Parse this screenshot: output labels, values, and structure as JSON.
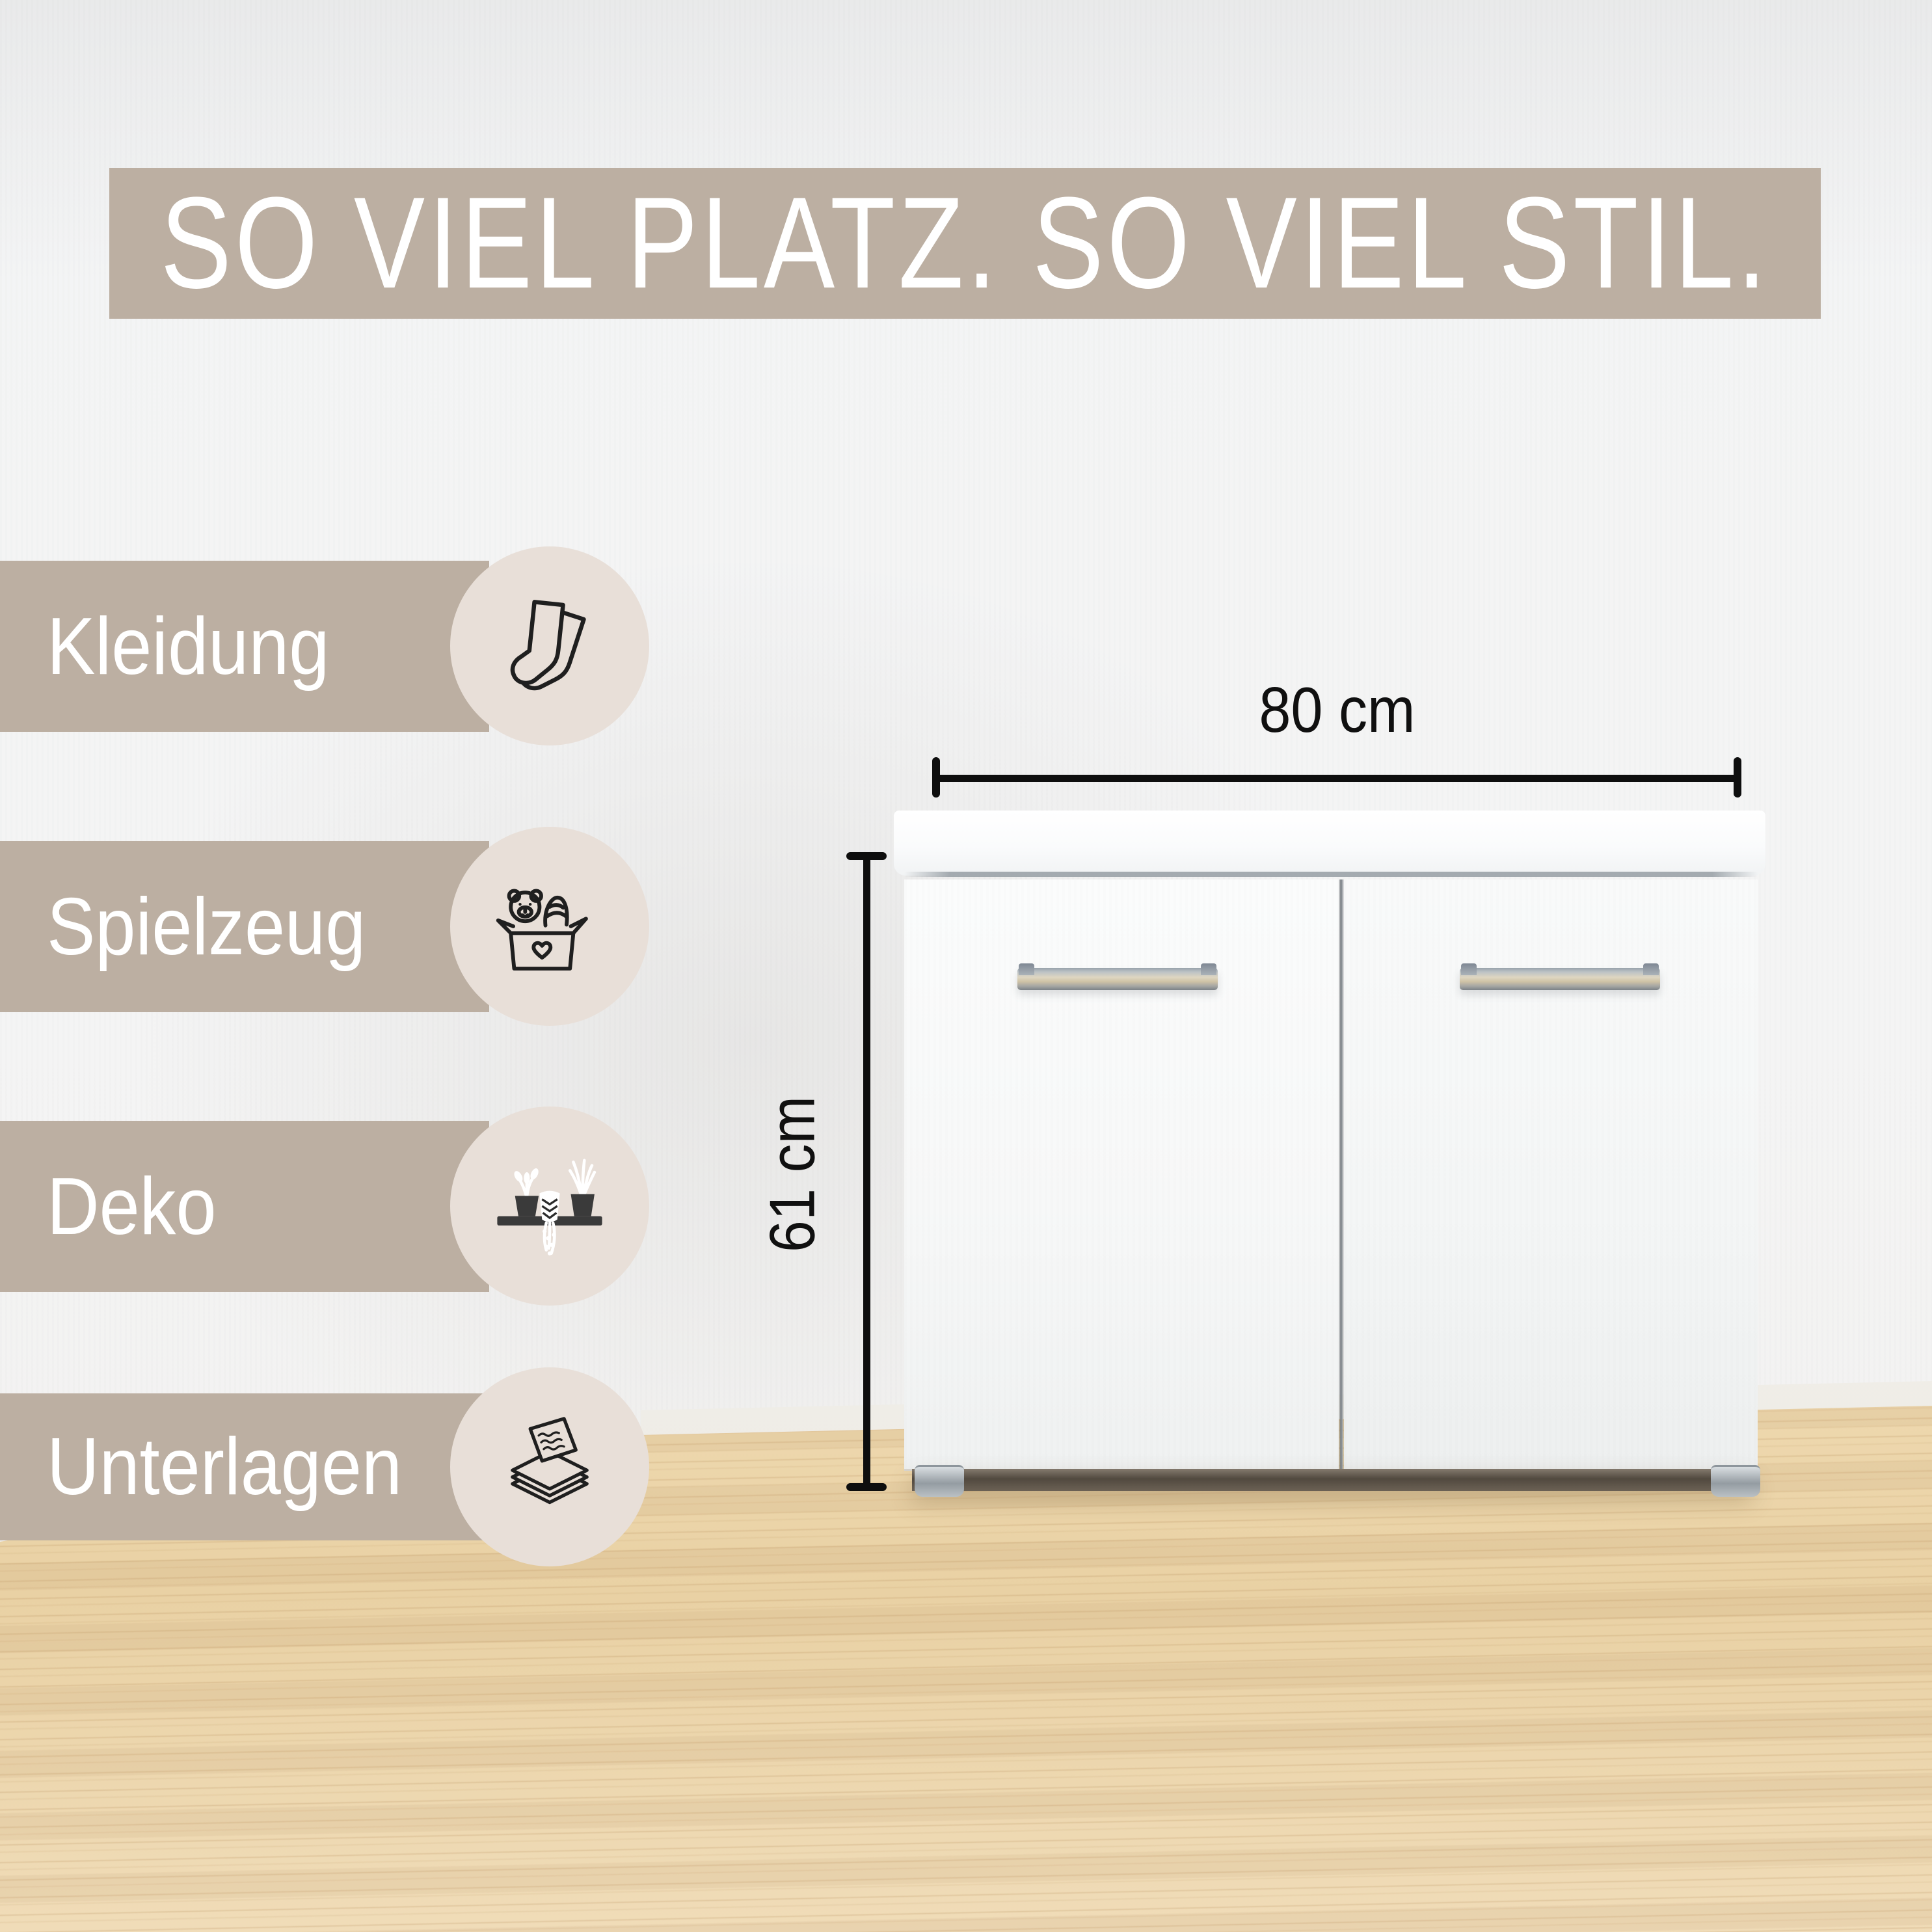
{
  "headline": "SO VIEL PLATZ. SO VIEL STIL.",
  "features": [
    {
      "label": "Kleidung",
      "icon": "socks-icon"
    },
    {
      "label": "Spielzeug",
      "icon": "toy-box-icon"
    },
    {
      "label": "Deko",
      "icon": "shelf-plants-icon"
    },
    {
      "label": "Unterlagen",
      "icon": "paper-stack-icon"
    }
  ],
  "dimensions": {
    "width": "80 cm",
    "height": "61 cm"
  },
  "colors": {
    "banner": "#bcafa2",
    "icon_circle": "#e8dfd8",
    "wall": "#f3f4f5",
    "floor_wood": "#eed8ae",
    "headline_text": "#ffffff",
    "dimension_lines": "#0e0e0e",
    "cabinet": "#f9fafa"
  }
}
